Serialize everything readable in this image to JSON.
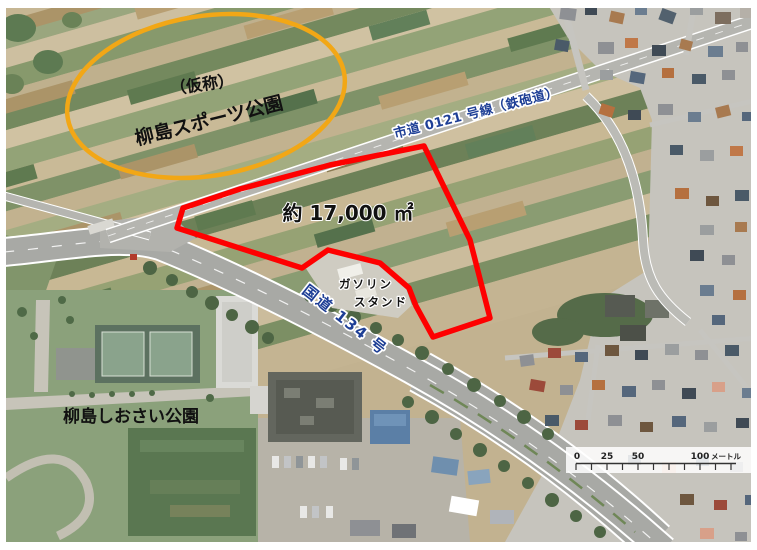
{
  "map": {
    "planned_park": {
      "line1": "（仮称）",
      "line2": "柳島スポーツ公園"
    },
    "site": {
      "area": "約 17,000 ㎡"
    },
    "roads": {
      "shido": "市道 0121 号線（鉄砲道）",
      "kokudo": "国道 134 号"
    },
    "gas_station": {
      "line1": "ガソリン",
      "line2": "スタンド"
    },
    "existing_park": {
      "name": "柳島しおさい公園"
    },
    "scale_bar": {
      "t0": "0",
      "t25": "25",
      "t50": "50",
      "t100": "100",
      "unit": "メートル"
    },
    "colors": {
      "site_outline": "#fe0000",
      "ellipse": "#f2a716",
      "road_text": "#1e3f96"
    }
  }
}
